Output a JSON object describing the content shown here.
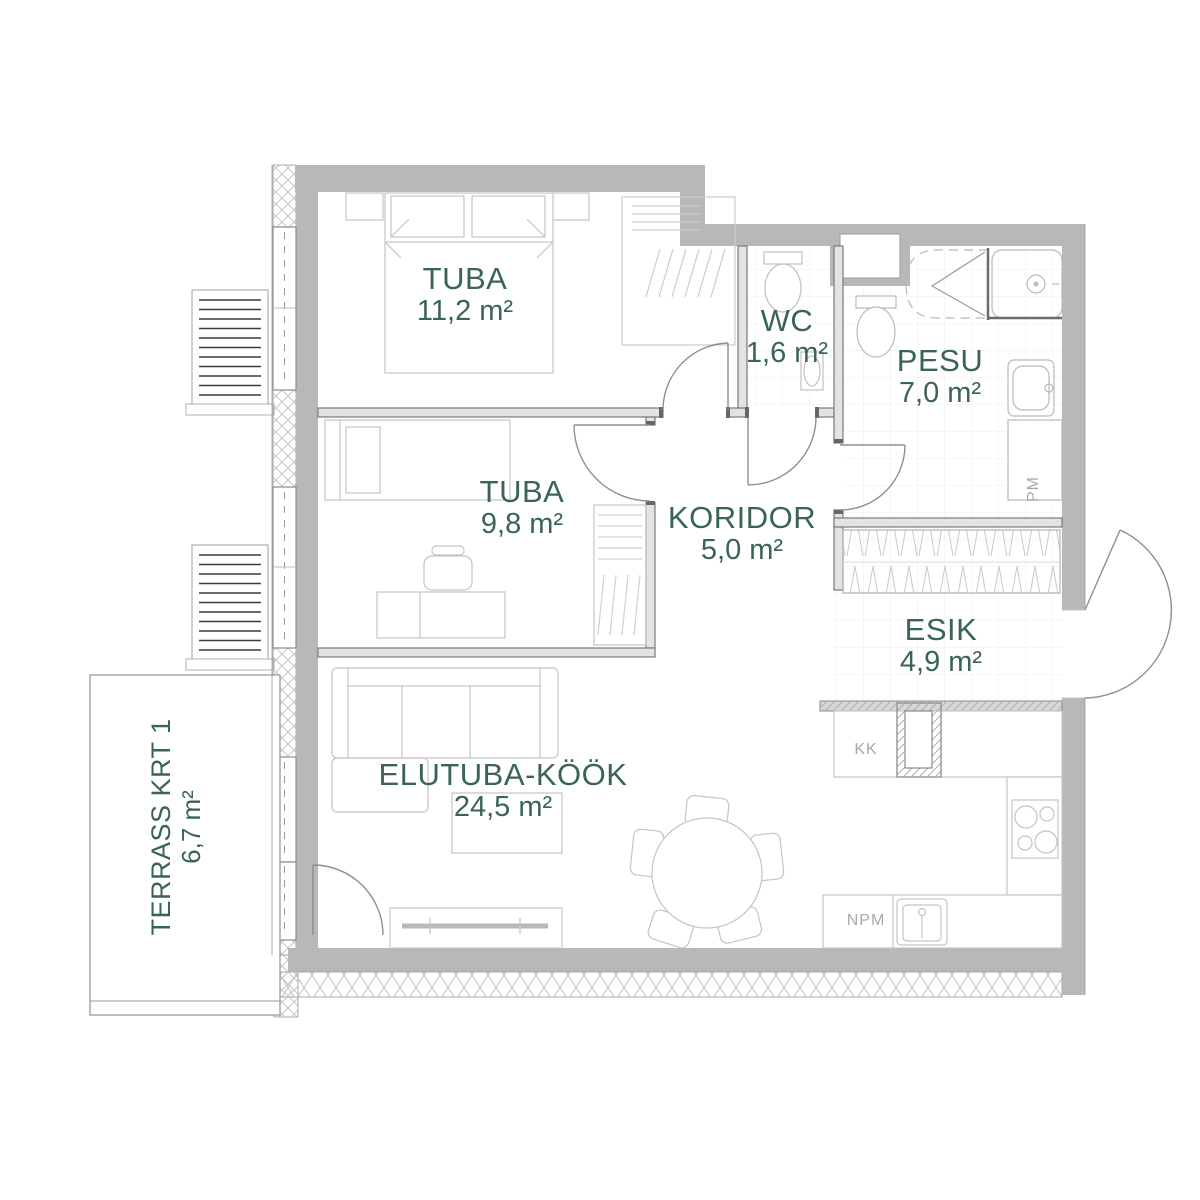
{
  "plan": {
    "rooms": [
      {
        "name": "TUBA",
        "area": "11,2 m²"
      },
      {
        "name": "WC",
        "area": "1,6 m²"
      },
      {
        "name": "PESU",
        "area": "7,0 m²"
      },
      {
        "name": "TUBA",
        "area": "9,8 m²"
      },
      {
        "name": "KORIDOR",
        "area": "5,0 m²"
      },
      {
        "name": "ESIK",
        "area": "4,9 m²"
      },
      {
        "name": "ELUTUBA-KÖÖK",
        "area": "24,5 m²"
      },
      {
        "name": "TERRASS KRT 1",
        "area": "6,7 m²"
      }
    ],
    "appliance_labels": {
      "washing_machine": "PM",
      "fridge": "KK",
      "dishwasher": "NPM"
    },
    "colors": {
      "room_label_green": "#3a6454",
      "wall_gray": "#b8b8b8",
      "appliance_label_gray": "#a9a9a9"
    }
  }
}
